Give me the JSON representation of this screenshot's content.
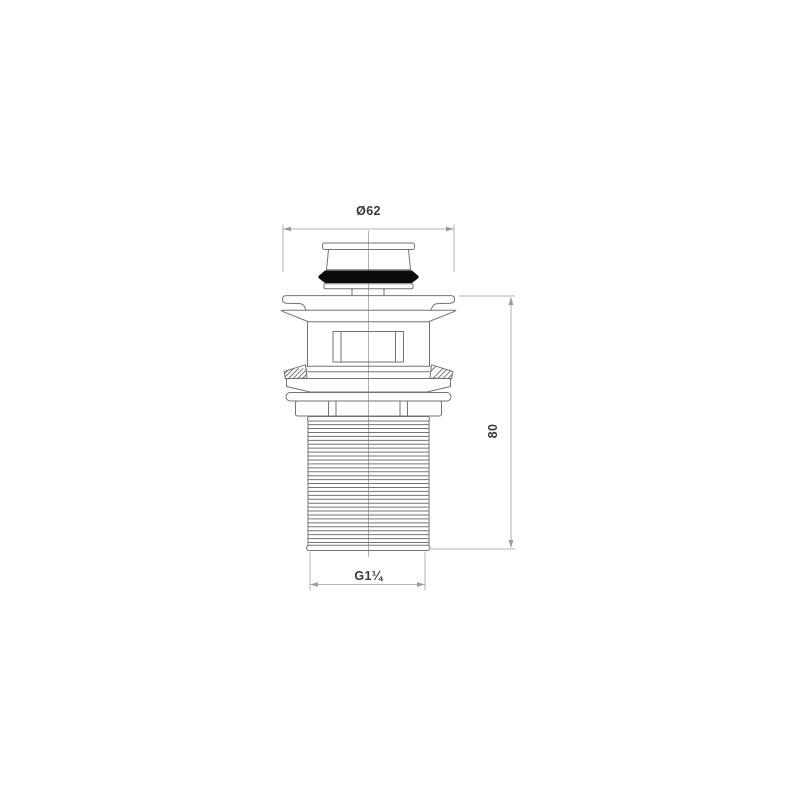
{
  "labels": {
    "diameter": "Ø62",
    "height": "80",
    "thread": "G1¼"
  },
  "colors": {
    "background": "#ffffff",
    "outline": "#737373",
    "centerline": "#8f8f8f",
    "dimension": "#9c9c9c",
    "hatch": "#6f6f6f",
    "seal": "#0c0c0c",
    "label_text": "#3a3a3a"
  }
}
